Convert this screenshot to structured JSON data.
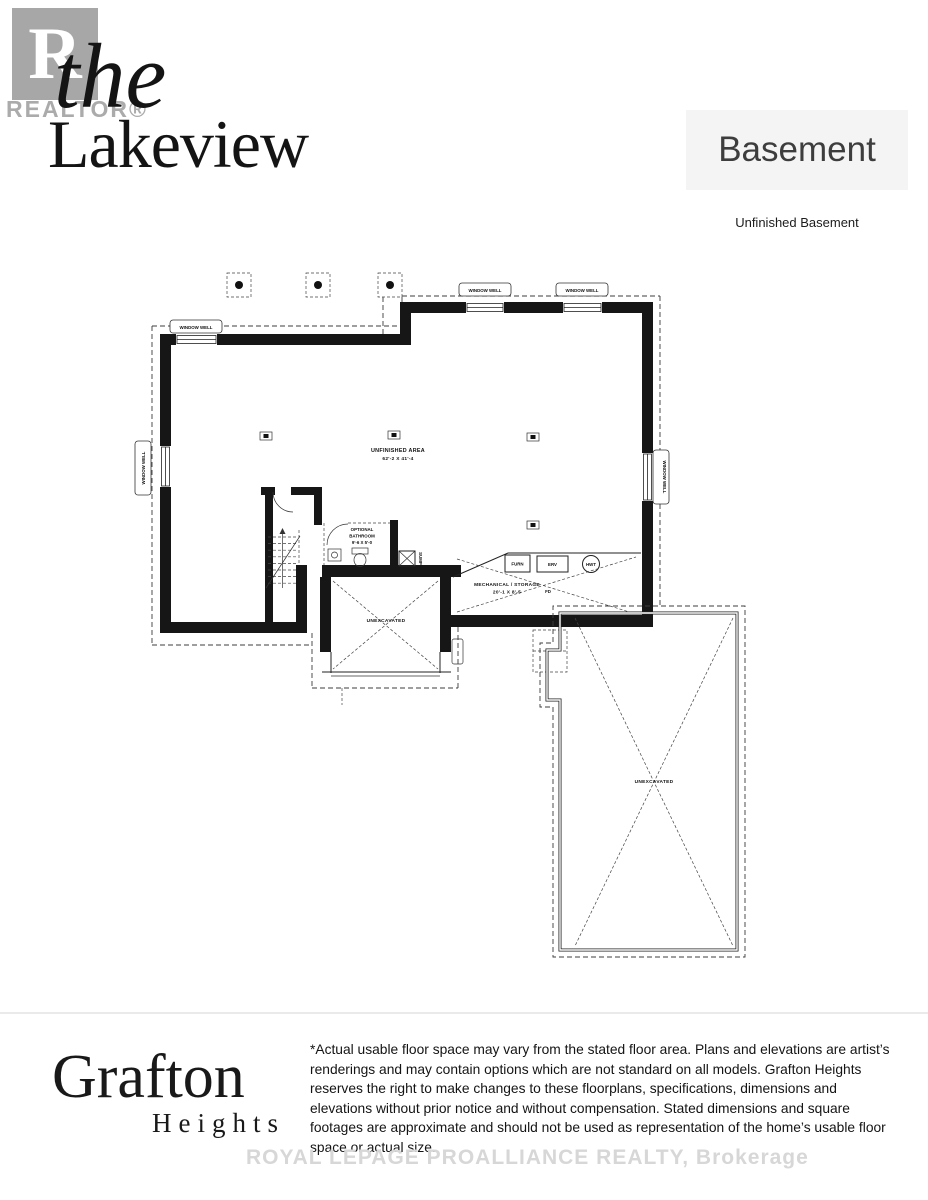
{
  "header": {
    "realtor_label": "REALTOR®",
    "realtor_r": "R",
    "title_prefix": "the",
    "title": "Lakeview",
    "page_title": "Basement",
    "subtitle": "Unfinished Basement"
  },
  "plan": {
    "window_well": "WINDOW WELL",
    "unfinished_area": "UNFINISHED AREA",
    "unfinished_dims": "62'-2 X 41'-4",
    "bath_line1": "OPTIONAL",
    "bath_line2": "BATHROOM",
    "bath_dims": "9'-6 X 5'-0",
    "mech": "MECHANICAL / STORAGE",
    "mech_dims": "20'-1 X 8'-5",
    "furnace": "FURN",
    "erv": "ERV",
    "hot_water_tank": "HWT",
    "floor_drain": "FD",
    "sump": "SUMP",
    "unexcavated": "UNEXCAVATED"
  },
  "footer": {
    "brand": "Grafton",
    "brand_suffix": "Heights",
    "disclaimer": "*Actual usable floor space may vary from the stated floor area. Plans and elevations are artist’s renderings and may contain options which are not standard on all models. Grafton Heights reserves the right to make changes to these floorplans, specifications, dimensions and elevations without prior notice and without compensation. Stated dimensions and square footages are approximate and should not be used as representation of the home’s usable floor space or actual size.",
    "watermark": "ROYAL LEPAGE PROALLIANCE REALTY, Brokerage"
  },
  "colors": {
    "wall": "#161616",
    "accent_gray_box": "#f4f4f4",
    "logo_gray": "#a7a7a7",
    "watermark_gray": "#d7d7d7"
  }
}
